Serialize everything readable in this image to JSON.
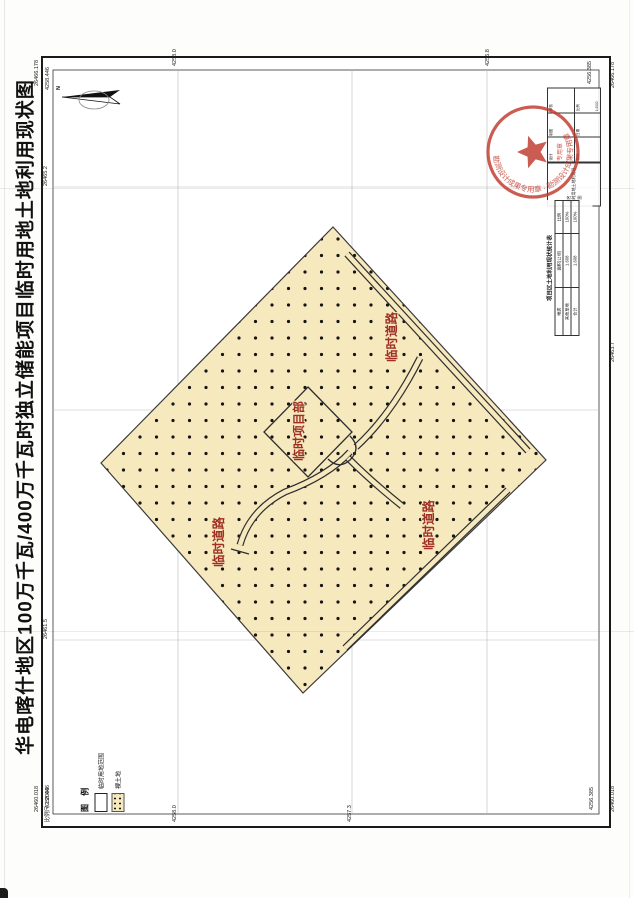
{
  "title": "华电喀什地区100万千瓦/400万千瓦时独立储能项目临时用地土地利用现状图",
  "scale_note": "比例尺 1:2000",
  "north_label": "N",
  "map_labels": {
    "site": "临时项目部",
    "road_ne": "临时道路",
    "road_se": "临时道路",
    "road_sw": "临时道路"
  },
  "legend": {
    "title": "图 例",
    "items": [
      {
        "label": "临时用地范围",
        "swatch": "outline"
      },
      {
        "label": "裸土地",
        "swatch": "dotted"
      }
    ]
  },
  "coords": {
    "tl": [
      "26466.178",
      "4258.446"
    ],
    "tr": [
      "4256.385",
      "26466.178"
    ],
    "bl": [
      "26460.018",
      "4258.446"
    ],
    "br": [
      "4256.385",
      "26460.018"
    ],
    "ticks": [
      {
        "label": "4258.0"
      },
      {
        "label": "4256.8"
      },
      {
        "label": "26465.2"
      },
      {
        "label": "26461.5"
      },
      {
        "label": "26463.7"
      },
      {
        "label": "4257.3"
      },
      {
        "label": "4258.0"
      }
    ]
  },
  "title_block": {
    "name_label": "图名",
    "name": "临时用地土地利用现状图",
    "cells": [
      {
        "label": "设计",
        "value": ""
      },
      {
        "label": "制图",
        "value": ""
      },
      {
        "label": "审核",
        "value": ""
      },
      {
        "label": "校核",
        "value": ""
      },
      {
        "label": "日期",
        "value": ""
      },
      {
        "label": "比例",
        "value": "1:2000"
      }
    ]
  },
  "summary_table": {
    "title": "项目区土地利用现状统计表",
    "headers": [
      "地类",
      "面积(公顷)",
      "比例"
    ],
    "rows": [
      [
        "其他草地",
        "1.608",
        "100%"
      ],
      [
        "合计",
        "1.608",
        "100%"
      ]
    ]
  },
  "seal": {
    "ring_text": "勘测设计成果专用章 · 勘测设计成果专用章",
    "center_text": "专用章"
  },
  "colors": {
    "parcel_fill": "#f7e9be",
    "red_label": "#9e2f26",
    "seal_red": "#c0392b"
  }
}
